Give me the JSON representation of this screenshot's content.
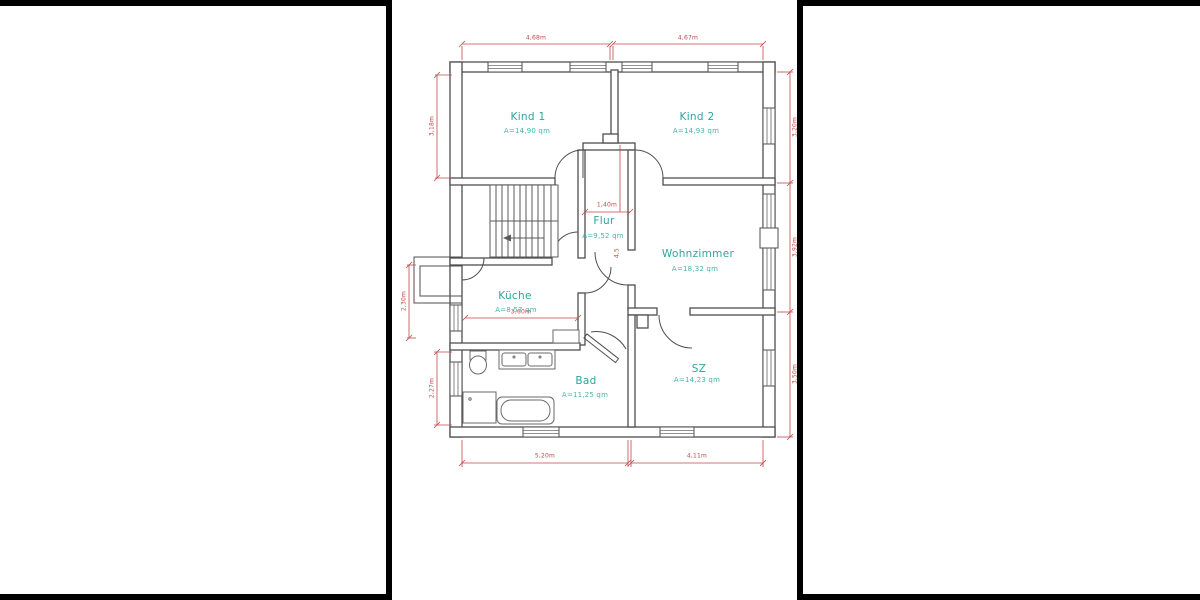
{
  "drawing": {
    "type": "floor-plan",
    "colors": {
      "wall": "#4f4f4f",
      "fixture": "#6a6a6a",
      "dimension": "#c24848",
      "room_label": "#2ea49e",
      "area_label": "#4cb2ab",
      "border": "#000000"
    }
  },
  "rooms": [
    {
      "id": "kind1",
      "name": "Kind 1",
      "area": "A=14,90 qm"
    },
    {
      "id": "kind2",
      "name": "Kind 2",
      "area": "A=14,93 qm"
    },
    {
      "id": "flur",
      "name": "Flur",
      "area": "A=9,52 qm"
    },
    {
      "id": "wohnzimmer",
      "name": "Wohnzimmer",
      "area": "A=18,32 qm"
    },
    {
      "id": "kueche",
      "name": "Küche",
      "area": "A=8,57 qm"
    },
    {
      "id": "bad",
      "name": "Bad",
      "area": "A=11,25 qm"
    },
    {
      "id": "sz",
      "name": "SZ",
      "area": "A=14,23 qm"
    }
  ],
  "dimensions": {
    "top_left": "4,68m",
    "top_right": "4,67m",
    "left_kind1": "3,18m",
    "left_balcony": "2,30m",
    "left_bad": "2,27m",
    "right_kind2": "3,20m",
    "right_wohnzimmer": "3,92m",
    "right_sz": "3,50m",
    "bottom_left": "5,20m",
    "bottom_right": "4,11m",
    "flur_width": "1,40m",
    "flur_door": "4,5",
    "kueche_width": "3,60m"
  }
}
